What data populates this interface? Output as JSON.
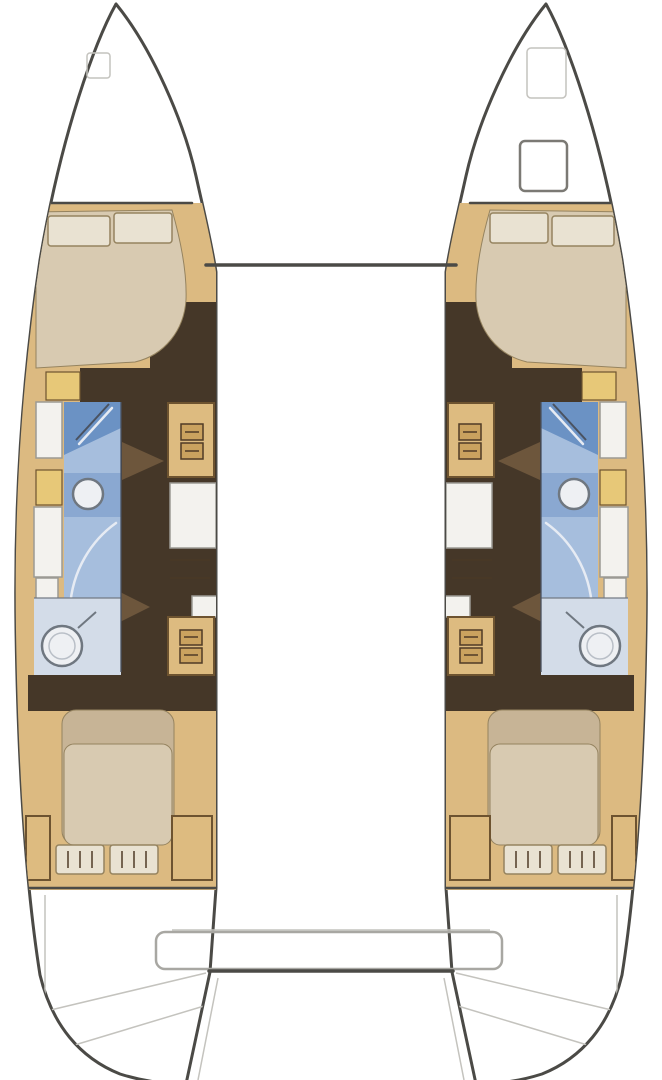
{
  "figure": {
    "kind": "catamaran-floor-plan",
    "label": "Top-view interior layout plan of a sailing catamaran with two hulls",
    "features": [
      "port-hull",
      "starboard-hull",
      "forward-double-berth-port",
      "forward-double-berth-starboard",
      "aft-double-berth-port",
      "aft-double-berth-starboard",
      "shower-port",
      "shower-starboard",
      "washbasin-port",
      "washbasin-starboard",
      "toilet-port",
      "toilet-starboard",
      "companionway-steps",
      "lockers",
      "foredeck-hatches",
      "forward-crossbeam",
      "aft-crossbeam",
      "transom-platform"
    ]
  },
  "colors": {
    "hull_outline": "#4b4a46",
    "hull_fill": "#ffffff",
    "deck_tan": "#dcba81",
    "floor_dark": "#453728",
    "bed_beige": "#d8cab1",
    "bed_shade": "#c7b496",
    "pillow": "#e9e2d2",
    "pillow_outline": "#95835f",
    "wood": "#ddbb80",
    "wood_border": "#6d5330",
    "drawer": "#4f3b26",
    "drawer_face": "#caa25f",
    "cabinet_white": "#f3f2ee",
    "cabinet_border": "#9b9a94",
    "locker_yellow": "#e7c878",
    "shower_blue": "#6b92c4",
    "shower_light": "#a6bedd",
    "sink_band": "#8aa8d1",
    "wc_floor": "#d3dce8",
    "fixture": "#eef0f3",
    "fixture_rim": "#6f7780",
    "fixture_inner": "#b9bfc7",
    "faint": "#c4c3be",
    "white_line": "#e6ebf3",
    "step": "#6d563c",
    "beam_gray": "#a8a7a2",
    "wall_blue": "#4a5260",
    "hatch_border": "#7b7974"
  }
}
